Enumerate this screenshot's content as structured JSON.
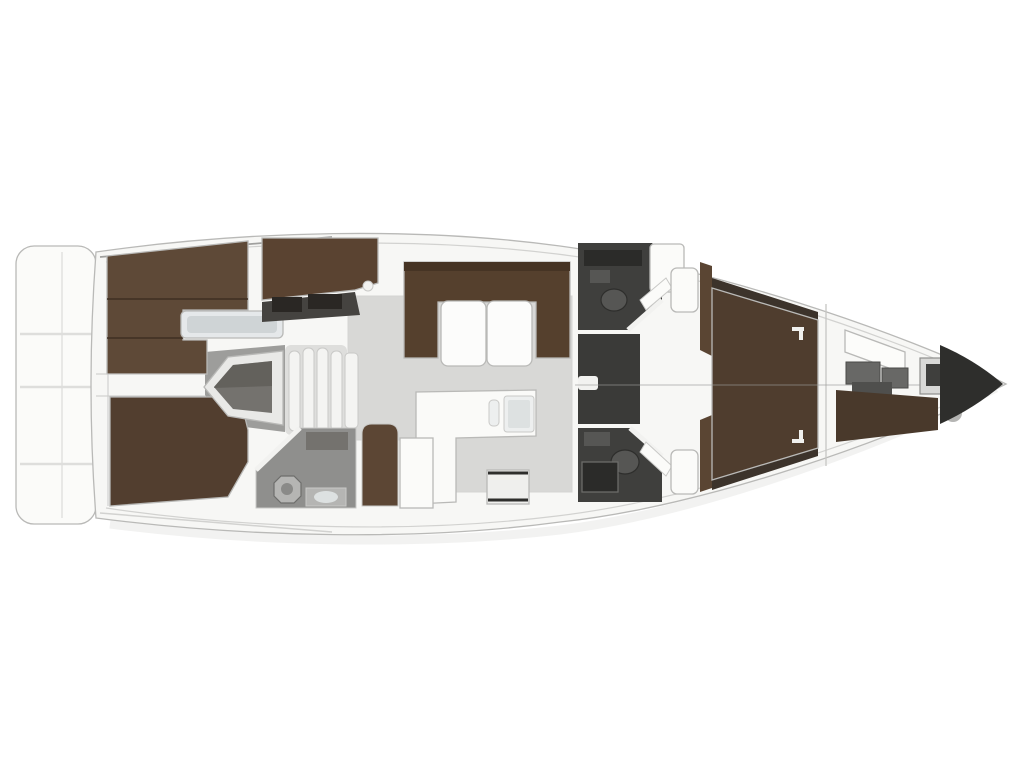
{
  "diagram": {
    "type": "yacht-interior-floor-plan",
    "orientation": "bow-right",
    "regions": [
      "swim-platform",
      "aft-cabin-port",
      "aft-cabin-starboard",
      "companionway",
      "salon",
      "settee",
      "dining-table",
      "galley",
      "nav-seat",
      "aft-head",
      "forward-head-port",
      "shower-room",
      "forward-head-starboard",
      "owner-cabin",
      "forepeak-locker",
      "bow-anchor-locker"
    ]
  },
  "colors": {
    "hull_fill": "#f7f7f5",
    "hull_stroke": "#bcbcba",
    "deck_line": "#d2d2d0",
    "accent_line": "#a0a09e",
    "shadow": "#e9e9e7",
    "platform_fill": "#fbfbf9",
    "platform_line": "#dededc",
    "floor_salon": "#d8d8d6",
    "floor_comp": "#9d9d9b",
    "bed_port": "#5e4937",
    "bed_stbd": "#523e2f",
    "bed_seam": "#3f2f22",
    "shelf_fill": "#e5e8ea",
    "shelf_inner": "#cfd4d6",
    "dresser": "#5a4331",
    "locker_dark": "#2a2724",
    "locker_mid": "#454340",
    "engine_outer": "#e9e9e7",
    "engine_mid": "#74726e",
    "engine_dark": "#55534f",
    "steps_base": "#dededc",
    "step_fill": "#f4f4f2",
    "settee": "#55402d",
    "settee_back": "#463424",
    "table": "#fcfcfb",
    "galley": "#fafaf8",
    "sink_outer": "#edefef",
    "sink_inner": "#dde1e1",
    "stove_face": "#efefed",
    "stove_dark": "#2e2e2c",
    "seat_brown": "#5c4634",
    "cabinet_white": "#fbfbf9",
    "head_floor": "#8f8f8d",
    "fixture_light": "#b5b5b3",
    "fixture_mid": "#8a8a88",
    "wet_dark": "#3f3f3d",
    "wet_mid": "#3a3a38",
    "wet_darker": "#2b2b29",
    "fixture_dark": "#565654",
    "door_white": "#f2f2f0",
    "wardrobe_brown": "#5a4533",
    "fwd_bed": "#4f3d2e",
    "side_locker": "#3c332b",
    "pillow": "#f0f0ee",
    "berth_white": "#fcfcfa",
    "equip_gray": "#686866",
    "equip_dark": "#4f4f4d",
    "forepeak_floor": "#49392b",
    "windlass_fill": "#d9d9d7",
    "windlass_dark": "#3f3f3d",
    "capsule": "#b5b5b3",
    "bow_dark": "#2e2e2c",
    "centerline": "#9a9a98",
    "wall_line": "#c6c6c4"
  }
}
